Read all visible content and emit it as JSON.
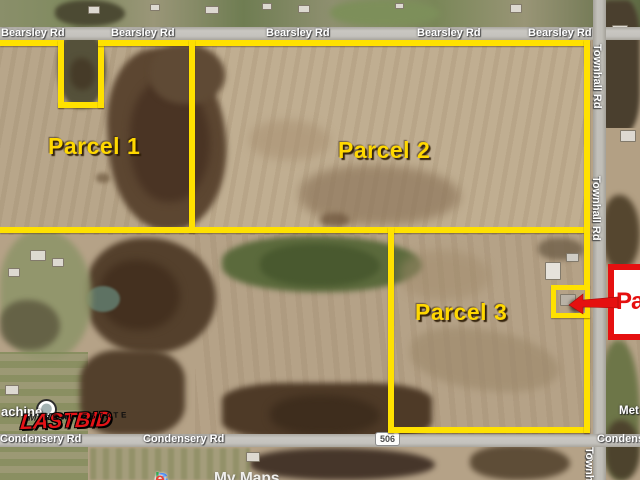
{
  "map": {
    "attribution": {
      "brand": "Google",
      "brand_letters": [
        "G",
        "o",
        "o",
        "g",
        "l",
        "e"
      ],
      "product": "My Maps"
    },
    "roads": {
      "bearsley": {
        "name": "Bearsley Rd"
      },
      "townhall": {
        "name": "Townhall Rd"
      },
      "condensery": {
        "name": "Condensery Rd"
      },
      "route_shield": "506"
    },
    "parcels": [
      {
        "label": "Parcel 1"
      },
      {
        "label": "Parcel 2"
      },
      {
        "label": "Parcel 3"
      }
    ],
    "callout": {
      "label": "Pa"
    },
    "poi": {
      "label": "achine"
    },
    "places": {
      "right_edge": "Met"
    },
    "watermark": {
      "line1": "MIEDEMA'S",
      "line2": "LASTBID",
      "line3": "REAL ESTATE"
    },
    "colors": {
      "boundary_yellow": "#FFE100",
      "parcel_label_yellow": "#FFD800",
      "callout_red": "#E51010",
      "road_gray": "#C2C0BC",
      "google_blue": "#4285F4",
      "google_red": "#EA4335",
      "google_yellow": "#FBBC05",
      "google_green": "#34A853"
    }
  }
}
